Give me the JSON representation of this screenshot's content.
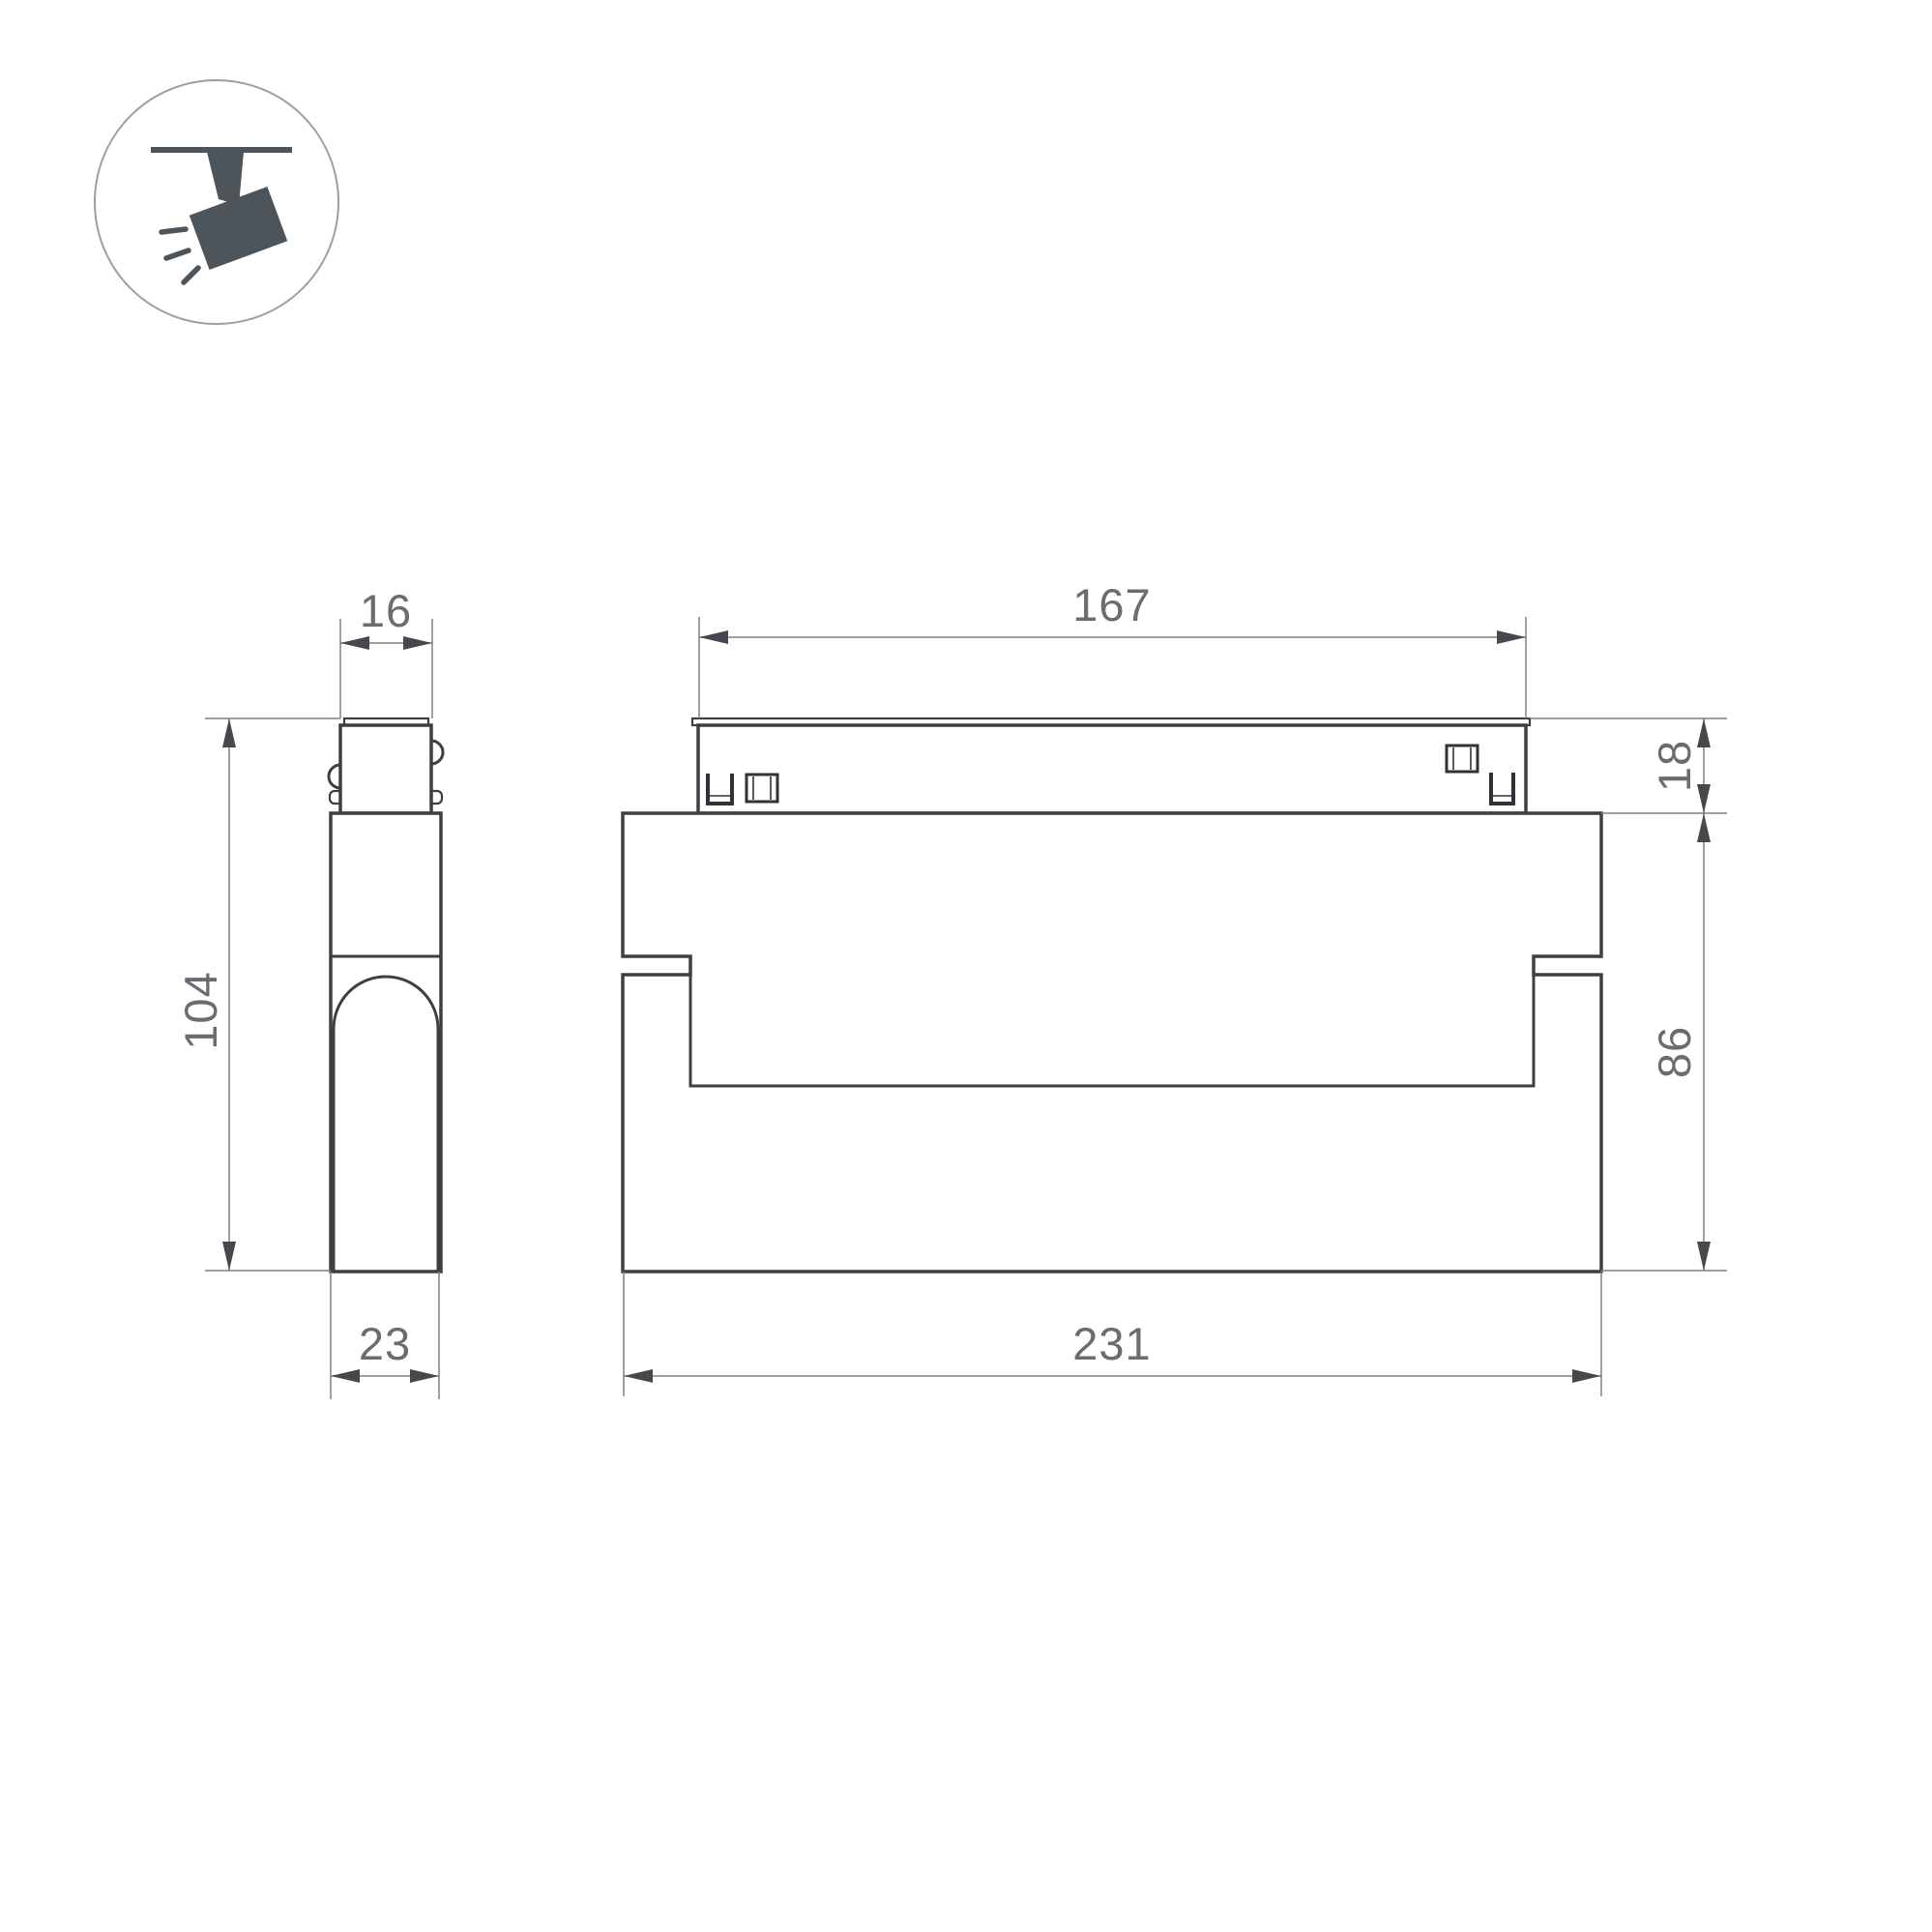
{
  "page": {
    "background": "#ffffff"
  },
  "icon": {
    "semantic": "ceiling-track-spotlight-pictogram",
    "fill_color": "#4d545a",
    "ring_color": "#9aa0a4"
  },
  "drawing": {
    "object_line_color": "#3c4043",
    "dimension_line_color": "#7d8084",
    "arrow_color": "#45484c",
    "label_color": "#696c70",
    "dimensions": {
      "side_view": {
        "adapter_width": "16",
        "total_height": "104",
        "body_depth": "23"
      },
      "front_view": {
        "adapter_length": "167",
        "adapter_height": "18",
        "body_height": "86",
        "body_length": "231"
      }
    }
  }
}
